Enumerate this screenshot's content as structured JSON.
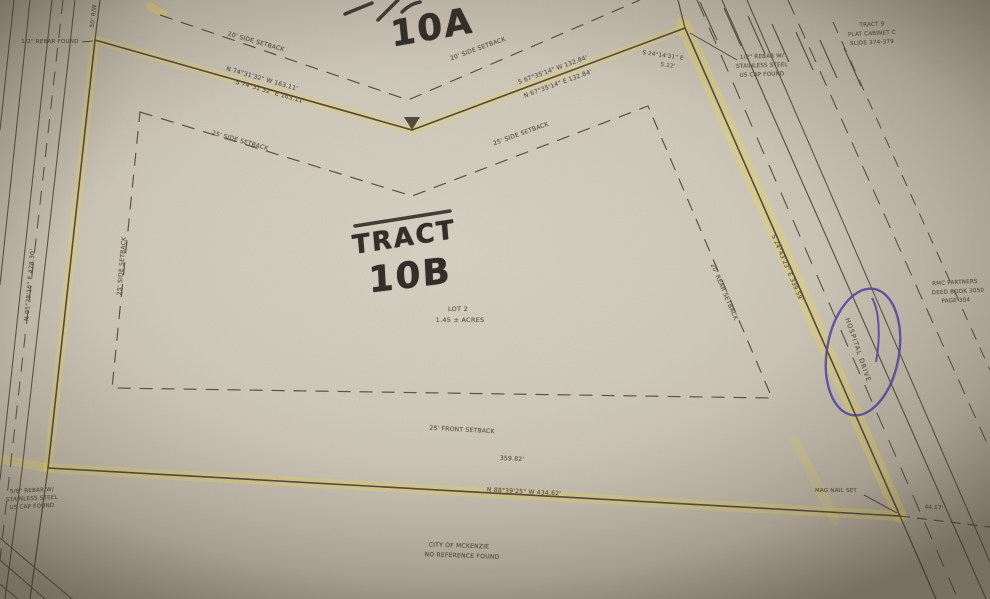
{
  "handwriting": {
    "tract_word": "TRACT",
    "tract_b": "10B",
    "tract_a": "10A"
  },
  "parcel": {
    "lot": "LOT 2",
    "area": "1.45 ± ACRES"
  },
  "bearings": {
    "nw_above": "N 74°31'32\" W  163.11'",
    "nw_below": "S 74°31'32\" E  163.11'",
    "ne_above": "S 67°35'14\" W  132.84'",
    "ne_below": "N 67°35'14\" E  132.84'",
    "corner": "S 24°14'31\" E",
    "corner_dist": "5.12'",
    "east": "S 24°43'23\" E  339.59'",
    "west": "N 05°28'16\" E  428.30'",
    "south": "N 88°39'25\" W  434.62'",
    "south_partial": "359.82'",
    "south_extra": "44.17'",
    "right_of_way": "50' R/W"
  },
  "setbacks": {
    "outer_left": "20' SIDE SETBACK",
    "outer_right": "20' SIDE SETBACK",
    "inner_left_top": "25' SIDE SETBACK",
    "inner_right_top": "25' SIDE SETBACK",
    "inner_west": "25' SIDE SETBACK",
    "rear": "20' REAR SETBACK",
    "front": "25' FRONT SETBACK"
  },
  "monuments": {
    "nw": "1/2\" REBAR FOUND",
    "ne": [
      "1/2\" REBAR W/",
      "STAINLESS STEEL",
      "US CAP FOUND"
    ],
    "sw": [
      "5/8\" REBAR W/",
      "STAINLESS STEEL",
      "US CAP FOUND"
    ],
    "se": "MAG NAIL SET"
  },
  "adjoiners": {
    "tract9": [
      "TRACT 9",
      "PLAT CABINET C",
      "SLIDE 374-379"
    ],
    "east_owner": [
      "RMC PARTNERS",
      "DEED BOOK 3050",
      "PAGE 304"
    ],
    "city": [
      "CITY OF MCKENZIE",
      "NO REFERENCE FOUND"
    ]
  },
  "roads": {
    "east": "HOSPITAL DRIVE"
  },
  "colors": {
    "highlight": "#e7d463",
    "pen": "#4a3da0",
    "ink": "#4f463a"
  }
}
